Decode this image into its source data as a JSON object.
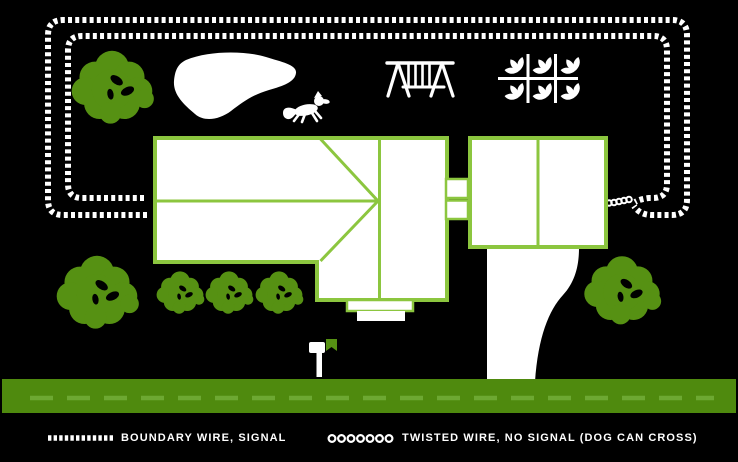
{
  "scene": {
    "colors": {
      "background": "#000000",
      "foliage": "#569113",
      "house_stroke": "#8cc63f",
      "road": "#4f8a0e",
      "road_dash": "#6da832",
      "wire": "#ffffff"
    },
    "objects": [
      "boundary-wire-double-dashed-loop",
      "twisted-wire-link-to-garage",
      "house-roof-plan",
      "garage",
      "breezeway",
      "porch-steps",
      "driveway",
      "pond",
      "dog",
      "swing-set",
      "garden-plot",
      "mailbox",
      "street-with-lane-dashes",
      "trees",
      "bushes"
    ]
  },
  "legend": {
    "boundary_label": "BOUNDARY WIRE, SIGNAL",
    "twisted_label": "TWISTED WIRE, NO SIGNAL (DOG CAN CROSS)"
  }
}
